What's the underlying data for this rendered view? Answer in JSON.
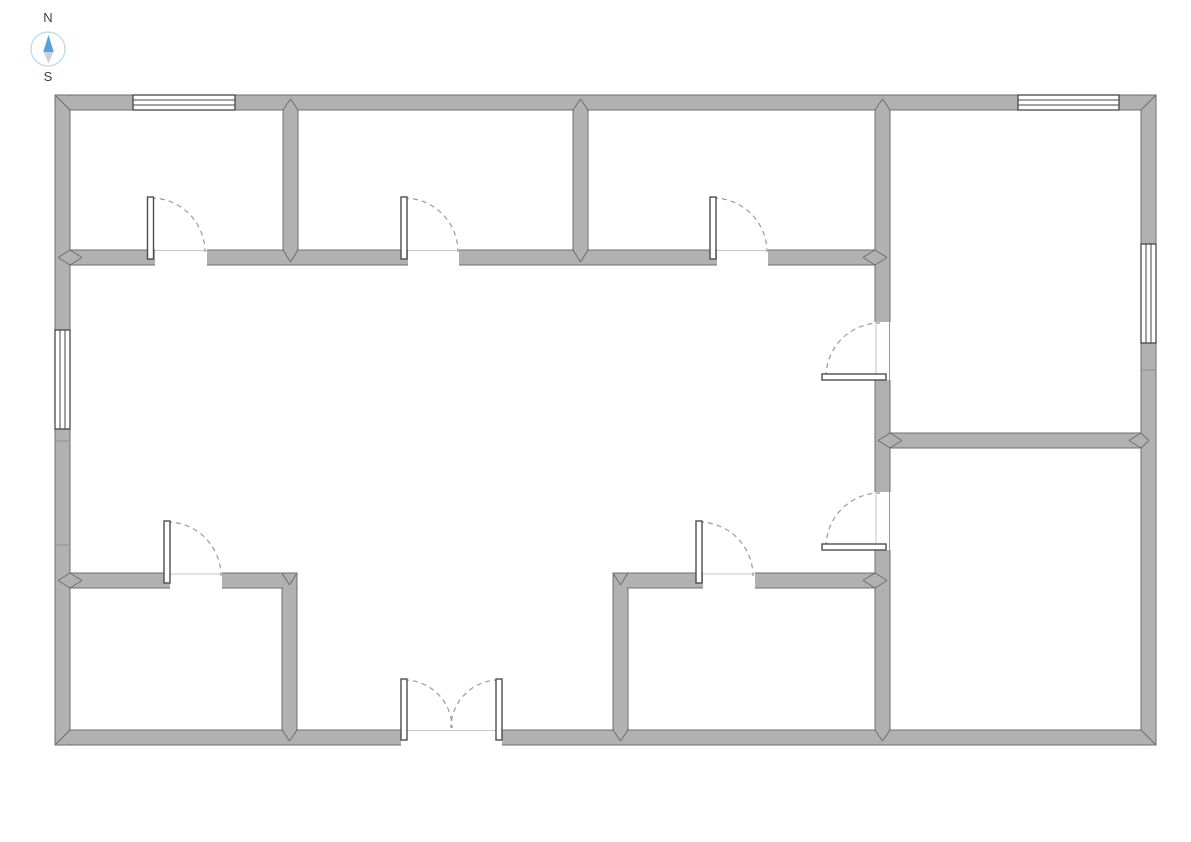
{
  "page": {
    "background": "#ffffff"
  },
  "compass": {
    "north_label": "N",
    "south_label": "S",
    "ring_color": "#b3d9ec",
    "north_color": "#57a3d9",
    "south_color": "#c9d2d9",
    "label_color": "#404040"
  },
  "colors": {
    "wall_fill": "#b1b1b1",
    "wall_edge": "#6f6f6f",
    "window_frame": "#474747",
    "door_leaf_edge": "#4d4d4d",
    "door_arc": "#9b9b9b",
    "sill": "#c6c6c6",
    "room_fill": "#ffffff"
  },
  "floorplan": {
    "walls": [
      {
        "name": "outer-wall-top",
        "x": 55,
        "y": 95,
        "w": 1101,
        "h": 15
      },
      {
        "name": "outer-wall-bottom",
        "x": 55,
        "y": 730,
        "w": 1101,
        "h": 15
      },
      {
        "name": "outer-wall-left",
        "x": 55,
        "y": 95,
        "w": 15,
        "h": 650
      },
      {
        "name": "outer-wall-right",
        "x": 1141,
        "y": 95,
        "w": 15,
        "h": 650
      },
      {
        "name": "wall-top-rooms-front",
        "x": 70,
        "y": 250,
        "w": 820,
        "h": 15
      },
      {
        "name": "wall-right-rooms-divider",
        "x": 890,
        "y": 433,
        "w": 251,
        "h": 15
      },
      {
        "name": "wall-bottom-left-room-top",
        "x": 70,
        "y": 573,
        "w": 227,
        "h": 15
      },
      {
        "name": "wall-bottom-mid-room-top",
        "x": 613,
        "y": 573,
        "w": 264,
        "h": 15
      },
      {
        "name": "wall-room1-room2-divider",
        "x": 283,
        "y": 110,
        "w": 15,
        "h": 140
      },
      {
        "name": "wall-room2-room3-divider",
        "x": 573,
        "y": 110,
        "w": 15,
        "h": 140
      },
      {
        "name": "wall-bottom-left-room-right",
        "x": 282,
        "y": 588,
        "w": 15,
        "h": 142
      },
      {
        "name": "wall-bottom-mid-room-left",
        "x": 613,
        "y": 588,
        "w": 15,
        "h": 142
      },
      {
        "name": "wall-right-rooms-left",
        "x": 875,
        "y": 110,
        "w": 15,
        "h": 620
      }
    ],
    "patches": [
      {
        "x": 56,
        "y": 108.5,
        "w": 13,
        "h": 3
      },
      {
        "x": 68.5,
        "y": 96,
        "w": 3,
        "h": 13
      },
      {
        "x": 1142,
        "y": 108.5,
        "w": 13,
        "h": 3
      },
      {
        "x": 1139.5,
        "y": 96,
        "w": 3,
        "h": 13
      },
      {
        "x": 56,
        "y": 728.5,
        "w": 13,
        "h": 3
      },
      {
        "x": 68.5,
        "y": 731,
        "w": 3,
        "h": 13
      },
      {
        "x": 1142,
        "y": 728.5,
        "w": 13,
        "h": 3
      },
      {
        "x": 1139.5,
        "y": 731,
        "w": 3,
        "h": 13
      },
      {
        "x": 284,
        "y": 108.5,
        "w": 13,
        "h": 3
      },
      {
        "x": 574,
        "y": 108.5,
        "w": 13,
        "h": 3
      },
      {
        "x": 876,
        "y": 108.5,
        "w": 13,
        "h": 3
      },
      {
        "x": 284,
        "y": 248.5,
        "w": 13,
        "h": 3
      },
      {
        "x": 574,
        "y": 248.5,
        "w": 13,
        "h": 3
      },
      {
        "x": 873.5,
        "y": 251,
        "w": 3,
        "h": 13
      },
      {
        "x": 68.5,
        "y": 251,
        "w": 3,
        "h": 13
      },
      {
        "x": 888.5,
        "y": 434,
        "w": 3,
        "h": 13
      },
      {
        "x": 1139.5,
        "y": 434,
        "w": 3,
        "h": 13
      },
      {
        "x": 68.5,
        "y": 574,
        "w": 3,
        "h": 13
      },
      {
        "x": 283,
        "y": 586.5,
        "w": 13,
        "h": 3
      },
      {
        "x": 614,
        "y": 586.5,
        "w": 13,
        "h": 3
      },
      {
        "x": 873.5,
        "y": 574,
        "w": 3,
        "h": 13
      },
      {
        "x": 283,
        "y": 728.5,
        "w": 13,
        "h": 3
      },
      {
        "x": 614,
        "y": 728.5,
        "w": 13,
        "h": 3
      },
      {
        "x": 876,
        "y": 728.5,
        "w": 13,
        "h": 3
      }
    ],
    "door_openings": [
      {
        "name": "opening-room1",
        "x": 155,
        "y": 248,
        "w": 52,
        "h": 19
      },
      {
        "name": "opening-room2",
        "x": 408,
        "y": 248,
        "w": 51,
        "h": 19
      },
      {
        "name": "opening-room3",
        "x": 717,
        "y": 248,
        "w": 51,
        "h": 19
      },
      {
        "name": "opening-upper-right-room",
        "x": 873,
        "y": 322,
        "w": 19,
        "h": 58
      },
      {
        "name": "opening-lower-right-room",
        "x": 873,
        "y": 492,
        "w": 19,
        "h": 58
      },
      {
        "name": "opening-bottom-left-room",
        "x": 170,
        "y": 571,
        "w": 52,
        "h": 19
      },
      {
        "name": "opening-bottom-mid-room",
        "x": 703,
        "y": 571,
        "w": 52,
        "h": 19
      },
      {
        "name": "opening-main-entrance",
        "x": 401,
        "y": 728,
        "w": 101,
        "h": 18
      }
    ],
    "sills": [
      {
        "x1": 155,
        "y1": 250.5,
        "x2": 207,
        "y2": 250.5,
        "tone": "light"
      },
      {
        "x1": 408,
        "y1": 250.5,
        "x2": 459,
        "y2": 250.5,
        "tone": "light"
      },
      {
        "x1": 717,
        "y1": 250.5,
        "x2": 768,
        "y2": 250.5,
        "tone": "light"
      },
      {
        "x1": 876,
        "y1": 322,
        "x2": 876,
        "y2": 380,
        "tone": "light"
      },
      {
        "x1": 889.5,
        "y1": 322,
        "x2": 889.5,
        "y2": 380,
        "tone": "mid"
      },
      {
        "x1": 876,
        "y1": 492,
        "x2": 876,
        "y2": 550,
        "tone": "light"
      },
      {
        "x1": 889.5,
        "y1": 492,
        "x2": 889.5,
        "y2": 550,
        "tone": "mid"
      },
      {
        "x1": 170,
        "y1": 574,
        "x2": 222,
        "y2": 574,
        "tone": "light"
      },
      {
        "x1": 703,
        "y1": 574,
        "x2": 755,
        "y2": 574,
        "tone": "light"
      },
      {
        "x1": 401,
        "y1": 730.5,
        "x2": 502,
        "y2": 730.5,
        "tone": "light"
      }
    ],
    "seams": [
      {
        "x1": 55,
        "y1": 441,
        "x2": 70,
        "y2": 441
      },
      {
        "x1": 55,
        "y1": 545,
        "x2": 70,
        "y2": 545
      },
      {
        "x1": 1141,
        "y1": 370,
        "x2": 1156,
        "y2": 370
      }
    ],
    "joints": [
      [
        55,
        95,
        70,
        110
      ],
      [
        1156,
        95,
        1141,
        110
      ],
      [
        55,
        745,
        70,
        730
      ],
      [
        1156,
        745,
        1141,
        730
      ],
      [
        283,
        110,
        290.5,
        99
      ],
      [
        290.5,
        99,
        298,
        110
      ],
      [
        573,
        110,
        580.5,
        99
      ],
      [
        580.5,
        99,
        588,
        110
      ],
      [
        875,
        110,
        882.5,
        99
      ],
      [
        882.5,
        99,
        890,
        110
      ],
      [
        70,
        250,
        58,
        257.5
      ],
      [
        58,
        257.5,
        70,
        265
      ],
      [
        70,
        250,
        82,
        257.5
      ],
      [
        82,
        257.5,
        70,
        265
      ],
      [
        283,
        250,
        290.5,
        262
      ],
      [
        290.5,
        262,
        298,
        250
      ],
      [
        573,
        250,
        580.5,
        262
      ],
      [
        580.5,
        262,
        588,
        250
      ],
      [
        875,
        250,
        863,
        257.5
      ],
      [
        863,
        257.5,
        875,
        265
      ],
      [
        875,
        250,
        887,
        257.5
      ],
      [
        887,
        257.5,
        875,
        265
      ],
      [
        890,
        433,
        878,
        440.5
      ],
      [
        878,
        440.5,
        890,
        448
      ],
      [
        890,
        433,
        902,
        440.5
      ],
      [
        902,
        440.5,
        890,
        448
      ],
      [
        1141,
        433,
        1129,
        440.5
      ],
      [
        1129,
        440.5,
        1141,
        448
      ],
      [
        1141,
        433,
        1149,
        440.5
      ],
      [
        1149,
        440.5,
        1141,
        448
      ],
      [
        70,
        573,
        58,
        580.5
      ],
      [
        58,
        580.5,
        70,
        588
      ],
      [
        70,
        573,
        82,
        580.5
      ],
      [
        82,
        580.5,
        70,
        588
      ],
      [
        282,
        573,
        289.5,
        585
      ],
      [
        289.5,
        585,
        297,
        573
      ],
      [
        613,
        573,
        620.5,
        585
      ],
      [
        620.5,
        585,
        628,
        573
      ],
      [
        875,
        573,
        863,
        580.5
      ],
      [
        863,
        580.5,
        875,
        588
      ],
      [
        875,
        573,
        887,
        580.5
      ],
      [
        887,
        580.5,
        875,
        588
      ],
      [
        282,
        730,
        289.5,
        741
      ],
      [
        289.5,
        741,
        297,
        730
      ],
      [
        613,
        730,
        620.5,
        741
      ],
      [
        620.5,
        741,
        628,
        730
      ],
      [
        875,
        730,
        882.5,
        741
      ],
      [
        882.5,
        741,
        890,
        730
      ]
    ],
    "windows": [
      {
        "name": "window-room1-north",
        "x": 133,
        "y": 95,
        "w": 102,
        "h": 15,
        "orientation": "horizontal"
      },
      {
        "name": "window-upper-right-room-north",
        "x": 1018,
        "y": 95,
        "w": 101,
        "h": 15,
        "orientation": "horizontal"
      },
      {
        "name": "window-hall-west",
        "x": 55,
        "y": 330,
        "w": 15,
        "h": 99,
        "orientation": "vertical"
      },
      {
        "name": "window-upper-right-room-east",
        "x": 1141,
        "y": 244,
        "w": 15,
        "h": 99,
        "orientation": "vertical"
      }
    ],
    "doors": [
      {
        "name": "door-room1",
        "leaf": {
          "x": 147.5,
          "y": 197,
          "w": 6,
          "h": 62
        },
        "arc": "M 151 198 A 54 54 0 0 1 205 252"
      },
      {
        "name": "door-room2",
        "leaf": {
          "x": 401,
          "y": 197,
          "w": 6,
          "h": 62
        },
        "arc": "M 404 198 A 54 54 0 0 1 458 252"
      },
      {
        "name": "door-room3",
        "leaf": {
          "x": 710,
          "y": 197,
          "w": 6,
          "h": 62
        },
        "arc": "M 713 198 A 54 54 0 0 1 767 252"
      },
      {
        "name": "door-upper-right-room",
        "leaf": {
          "x": 822,
          "y": 374,
          "w": 64,
          "h": 6
        },
        "arc": "M 826 377 A 54 54 0 0 1 880 323"
      },
      {
        "name": "door-lower-right-room",
        "leaf": {
          "x": 822,
          "y": 544,
          "w": 64,
          "h": 6
        },
        "arc": "M 826 547 A 54 54 0 0 1 880 493"
      },
      {
        "name": "door-bottom-left-room",
        "leaf": {
          "x": 164,
          "y": 521,
          "w": 6,
          "h": 62
        },
        "arc": "M 167 522 A 54 54 0 0 1 221 576"
      },
      {
        "name": "door-bottom-mid-room",
        "leaf": {
          "x": 696,
          "y": 521,
          "w": 6,
          "h": 62
        },
        "arc": "M 699 522 A 54 54 0 0 1 753 576"
      },
      {
        "name": "entrance-door-left",
        "leaf": {
          "x": 401,
          "y": 679,
          "w": 6,
          "h": 61
        },
        "arc": "M 404 680 A 48 48 0 0 1 452 728"
      },
      {
        "name": "entrance-door-right",
        "leaf": {
          "x": 496,
          "y": 679,
          "w": 6,
          "h": 61
        },
        "arc": "M 499 680 A 48 48 0 0 0 451 728"
      }
    ]
  }
}
